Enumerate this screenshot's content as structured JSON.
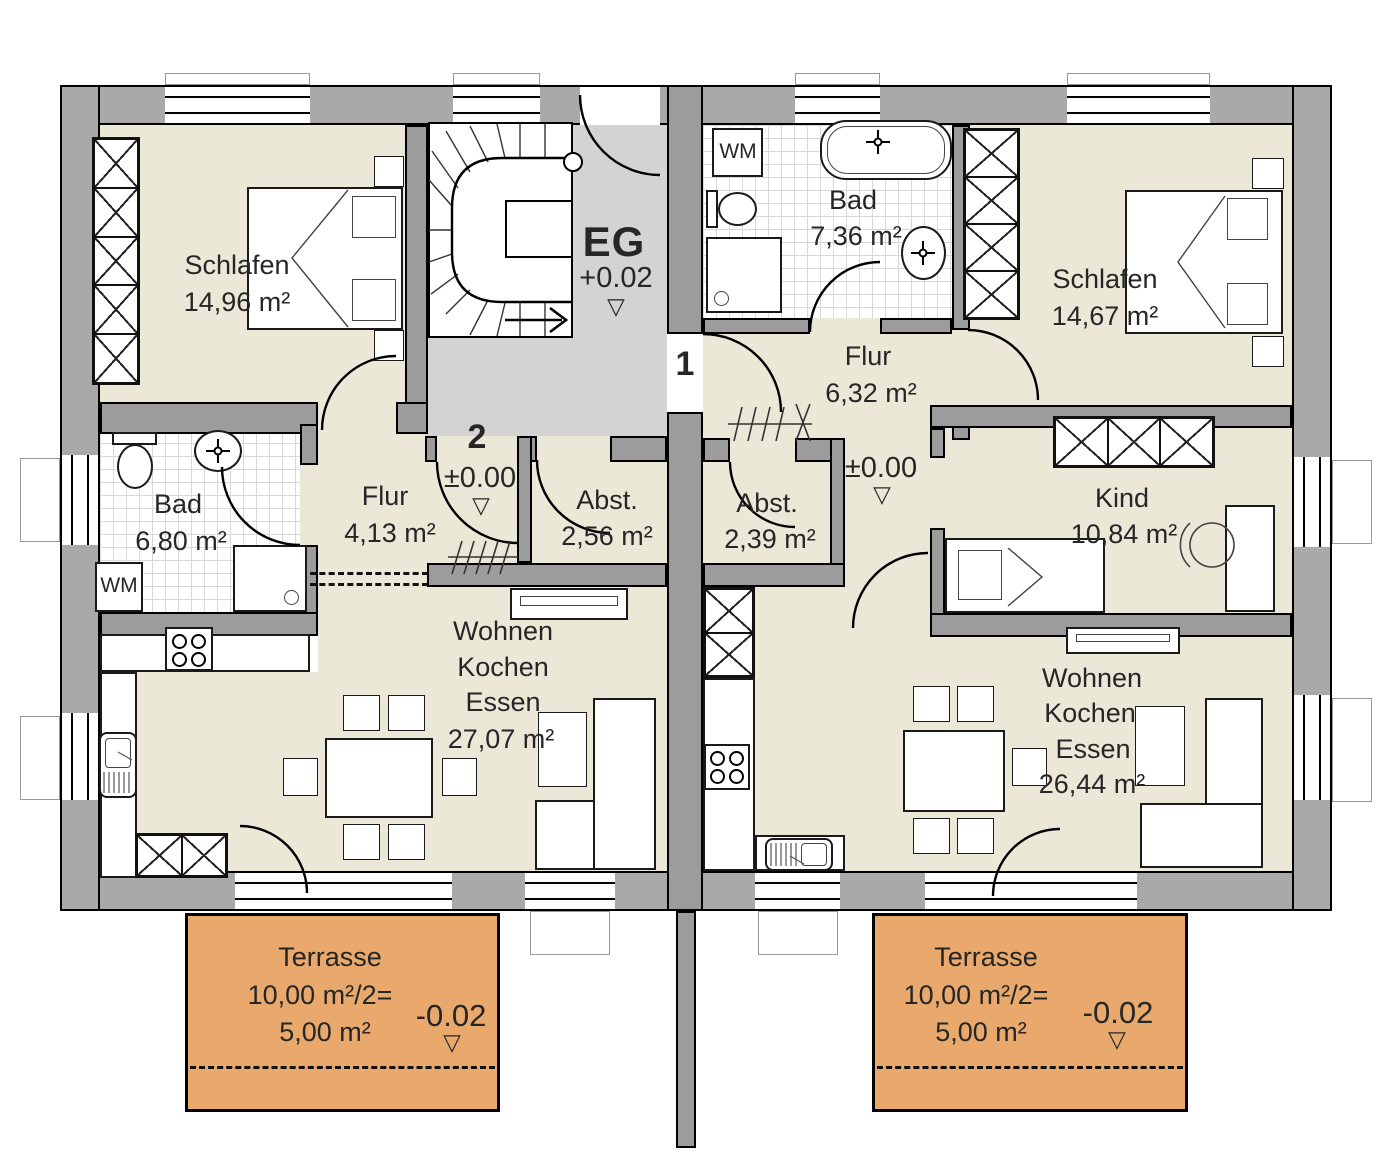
{
  "plan": {
    "stairwell": {
      "floor_label": "EG",
      "level": "+0.02",
      "marker": "▽",
      "unit1_door": "1",
      "unit2_door": "2"
    },
    "apartment_left": {
      "schlafen": {
        "name": "Schlafen",
        "area": "14,96 m²"
      },
      "bad": {
        "name": "Bad",
        "area": "6,80 m²"
      },
      "flur": {
        "name": "Flur",
        "area": "4,13 m²"
      },
      "abst": {
        "name": "Abst.",
        "area": "2,56 m²"
      },
      "wohnen": {
        "line1": "Wohnen",
        "line2": "Kochen",
        "line3": "Essen",
        "area": "27,07 m²"
      },
      "entry_level": "±0.00",
      "entry_marker": "▽",
      "wm": "WM",
      "terrasse": {
        "name": "Terrasse",
        "calc": "10,00 m²/2=",
        "area": "5,00 m²",
        "level": "-0.02",
        "marker": "▽"
      }
    },
    "apartment_right": {
      "bad": {
        "name": "Bad",
        "area": "7,36 m²"
      },
      "schlafen": {
        "name": "Schlafen",
        "area": "14,67 m²"
      },
      "flur": {
        "name": "Flur",
        "area": "6,32 m²"
      },
      "abst": {
        "name": "Abst.",
        "area": "2,39 m²"
      },
      "kind": {
        "name": "Kind",
        "area": "10,84 m²"
      },
      "wohnen": {
        "line1": "Wohnen",
        "line2": "Kochen",
        "line3": "Essen",
        "area": "26,44 m²"
      },
      "hall_level": "±0.00",
      "hall_marker": "▽",
      "wm": "WM",
      "terrasse": {
        "name": "Terrasse",
        "calc": "10,00 m²/2=",
        "area": "5,00 m²",
        "level": "-0.02",
        "marker": "▽"
      }
    },
    "colors": {
      "room": "#ece8d8",
      "hall": "#d3d3d3",
      "terrace": "#e9a86c",
      "wall": "#a9a9a9"
    }
  }
}
